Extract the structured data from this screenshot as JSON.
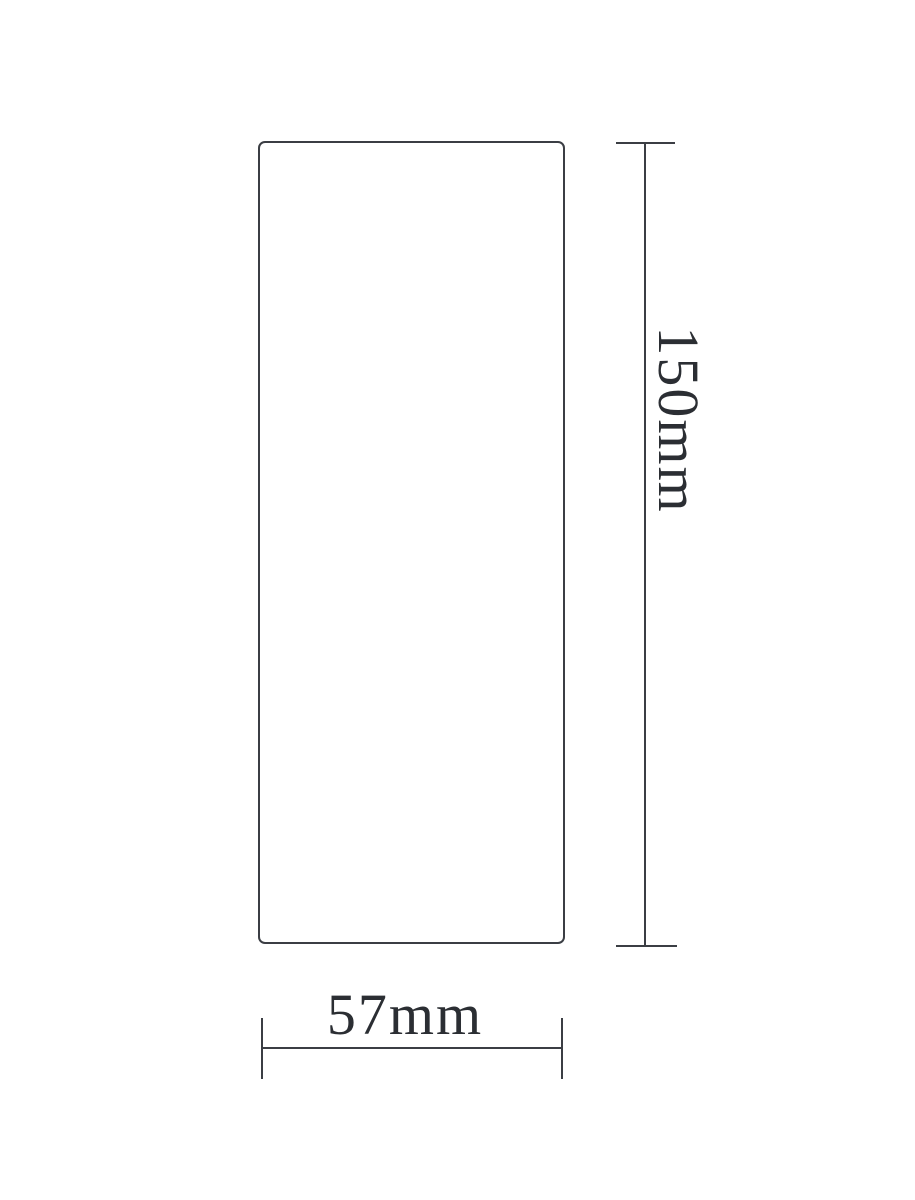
{
  "figure": {
    "type": "technical-dimension-drawing",
    "background_color": "#ffffff",
    "line_color": "#3b3e44",
    "text_color": "#2b2e33"
  },
  "dimensions": {
    "height": {
      "label": "150mm",
      "value": 150,
      "unit": "mm",
      "orientation": "vertical"
    },
    "width": {
      "label": "57mm",
      "value": 57,
      "unit": "mm",
      "orientation": "horizontal"
    }
  }
}
